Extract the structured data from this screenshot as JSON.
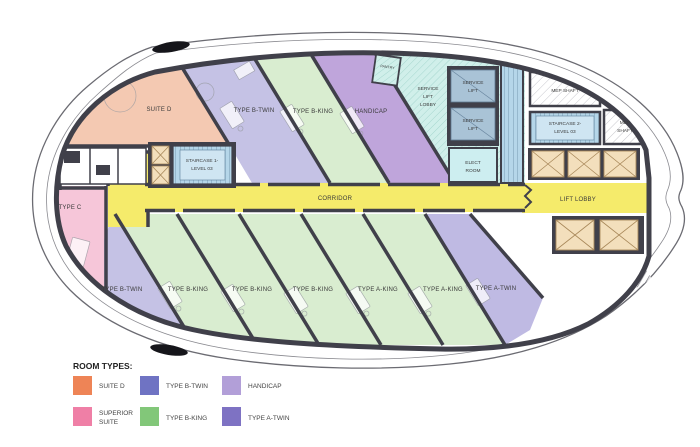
{
  "rooms": {
    "suite_d": "SUITE D",
    "type_b_twin": "TYPE B-TWIN",
    "type_b_king": "TYPE B-KING",
    "type_a_king": "TYPE A-KING",
    "type_a_twin": "TYPE A-TWIN",
    "type_c": "TYPE C",
    "handicap": "HANDICAP",
    "pantry": "PANTRY",
    "corridor": "CORRIDOR",
    "lift_lobby": "LIFT LOBBY",
    "service": "SERVICE",
    "lift": "LIFT",
    "lobby": "LOBBY",
    "elect": "ELECT",
    "room": "ROOM",
    "mep_shaft": "MEP SHAFT",
    "mep": "MEP",
    "shaft": "SHAFT",
    "staircase1_line1": "STAIRCASE 1-",
    "staircase2_line1": "STAIRCASE 2-",
    "level": "LEVEL 03"
  },
  "legend": {
    "title": "ROOM TYPES:",
    "items": [
      {
        "label": "SUITE D",
        "color": "#EE8456"
      },
      {
        "label": "TYPE B-TWIN",
        "color": "#6F73C3"
      },
      {
        "label": "HANDICAP",
        "color": "#B29FD8"
      },
      {
        "label_line1": "SUPERIOR",
        "label_line2": "SUITE",
        "color": "#EF7FA6"
      },
      {
        "label": "TYPE B-KING",
        "color": "#82C779"
      },
      {
        "label": "TYPE A-TWIN",
        "color": "#7E72C3"
      }
    ]
  },
  "colors": {
    "wall": "#40404A",
    "suite_d_fill": "#F4C9B2",
    "type_c_fill": "#F6C6D9",
    "b_twin_fill": "#C5C2E5",
    "green_fill": "#D9EDD0",
    "handicap_fill": "#BFA5DB",
    "a_twin_fill": "#BFBAE3",
    "corridor_fill": "#F5EB6B",
    "service_fill": "#D0EFEA",
    "service_lift_fill": "#A9C3D6",
    "elect_fill": "#CDEEF0",
    "stair_fill": "#B5D6E9",
    "lift_shaft_fill": "#F3DFBC"
  }
}
